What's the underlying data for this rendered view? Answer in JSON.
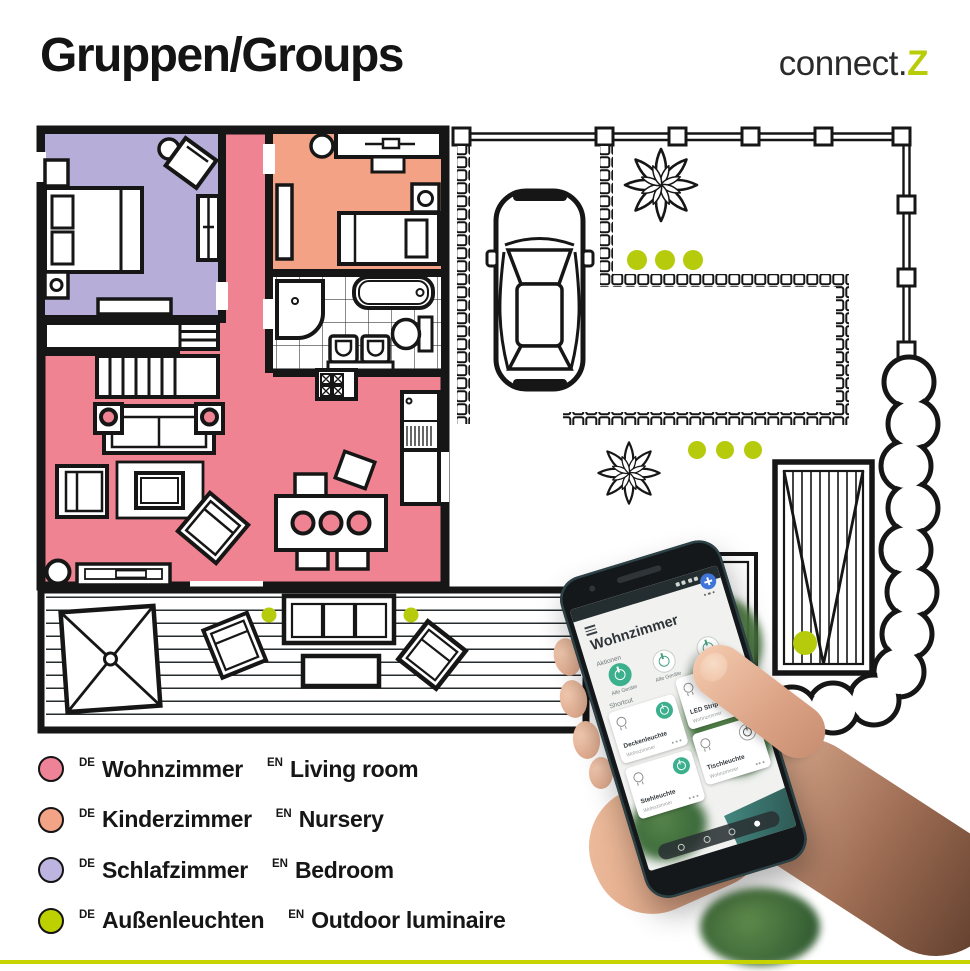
{
  "header": {
    "title": "Gruppen/Groups",
    "brand_text": "connect.",
    "brand_accent": "Z"
  },
  "legend": {
    "items": [
      {
        "tag_de": "DE",
        "name_de": "Wohnzimmer",
        "tag_en": "EN",
        "name_en": "Living room",
        "color": "#ee8398"
      },
      {
        "tag_de": "DE",
        "name_de": "Kinderzimmer",
        "tag_en": "EN",
        "name_en": "Nursery",
        "color": "#f4a486"
      },
      {
        "tag_de": "DE",
        "name_de": "Schlafzimmer",
        "tag_en": "EN",
        "name_en": "Bedroom",
        "color": "#bdb5e0"
      },
      {
        "tag_de": "DE",
        "name_de": "Außenleuchten",
        "tag_en": "EN",
        "name_en": "Outdoor luminaire",
        "color": "#bdd000"
      }
    ]
  },
  "floorplan": {
    "colors": {
      "living_room": "#f08392",
      "nursery": "#f3a286",
      "bedroom": "#b6aed9",
      "outdoor_dot": "#b5cb0c",
      "accent_circle": "#f08392"
    }
  },
  "phone": {
    "app": {
      "title": "Wohnzimmer",
      "actions_label": "Aktionen",
      "shortcut_label": "Shortcut",
      "action_buttons": [
        {
          "label": "Alle Geräte",
          "state": "on"
        },
        {
          "label": "Alle Geräte",
          "state": "off"
        },
        {
          "label": "Alle Geräte",
          "state": "off"
        }
      ],
      "cards": [
        {
          "name": "Deckenleuchte",
          "room": "Wohnzimmer",
          "state": "on"
        },
        {
          "name": "LED Stripe",
          "room": "Wohnzimmer",
          "state": "on"
        },
        {
          "name": "Stehleuchte",
          "room": "Wohnzimmer",
          "state": "on"
        },
        {
          "name": "Tischleuchte",
          "room": "Wohnzimmer",
          "state": "off"
        }
      ]
    }
  }
}
